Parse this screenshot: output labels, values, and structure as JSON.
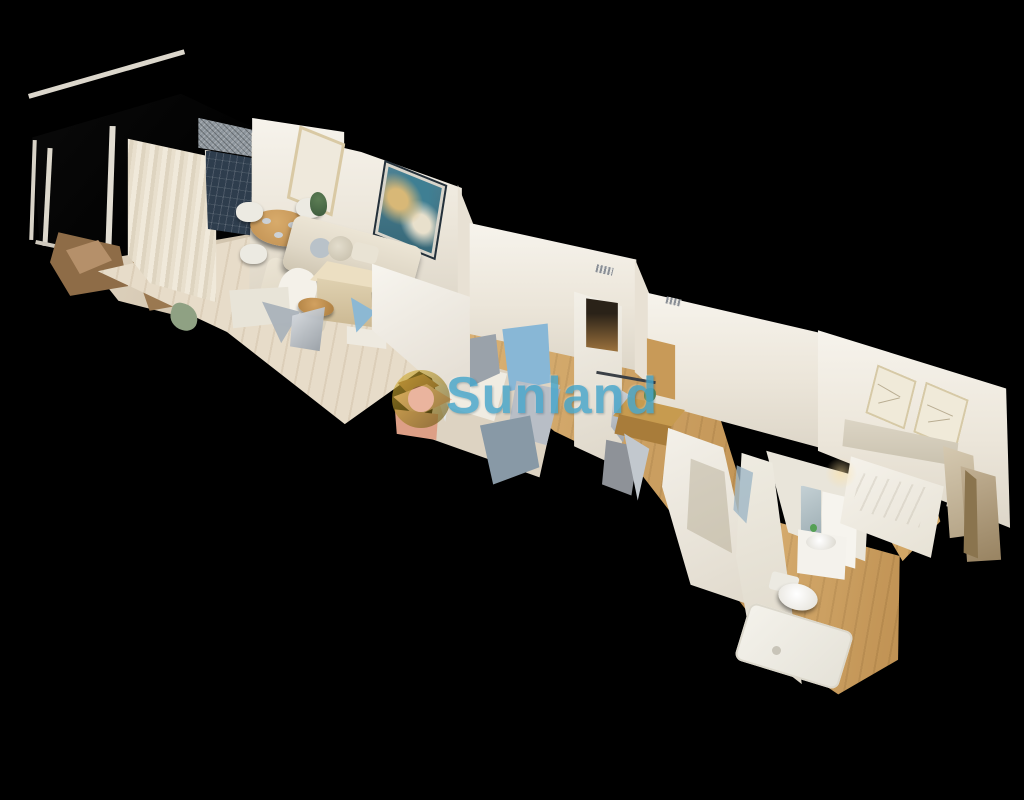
{
  "scene": {
    "type": "3d-dollhouse-view",
    "regions": [
      "terrace",
      "living-dining-room",
      "kitchenette",
      "bedroom-1",
      "hallway-office",
      "bathroom",
      "bedroom-2"
    ]
  },
  "watermark": {
    "text": "Sunland",
    "logo": "ring-logo"
  },
  "palette": {
    "background": "#000000",
    "watermark_text": "#47a6cb",
    "logo_gold": "#d2ad34",
    "logo_olive": "#6d5a11",
    "wall": "#f1ede5",
    "floor_oak": "#cfa05e",
    "floor_pale": "#e7dcc9",
    "window_dark": "#2e3d4d",
    "curtain": "#e9e2d2",
    "sofa": "#e0d8c7",
    "art_teal": "#3f7f93",
    "glitch_blue": "#88b7d6",
    "glitch_gray": "#9ba3ab",
    "debris_brown": "#8e6c47",
    "pink_box": "#eab49e"
  }
}
